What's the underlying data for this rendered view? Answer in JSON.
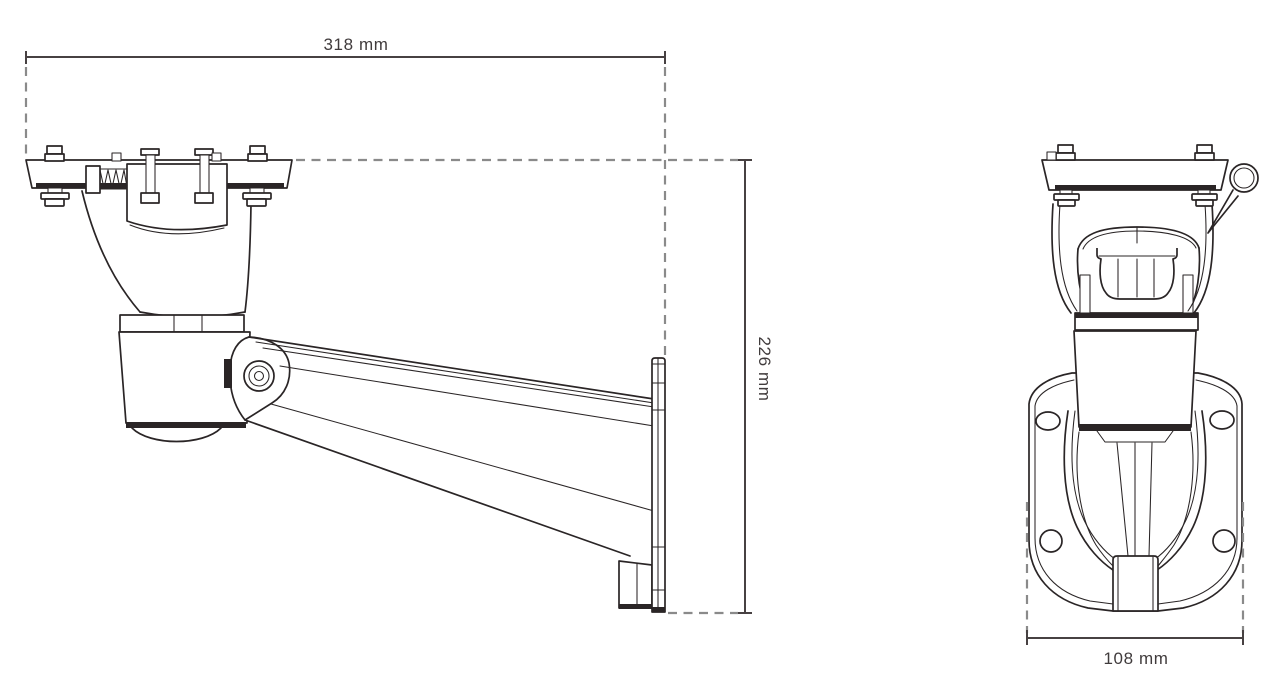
{
  "drawing": {
    "dimensions": {
      "overall_length": "318 mm",
      "overall_height": "226 mm",
      "base_width": "108 mm"
    },
    "colors": {
      "line": "#2a2526",
      "dimension_dash": "#8a8a8a",
      "dimension_text": "#403b3c",
      "background": "#ffffff"
    }
  }
}
